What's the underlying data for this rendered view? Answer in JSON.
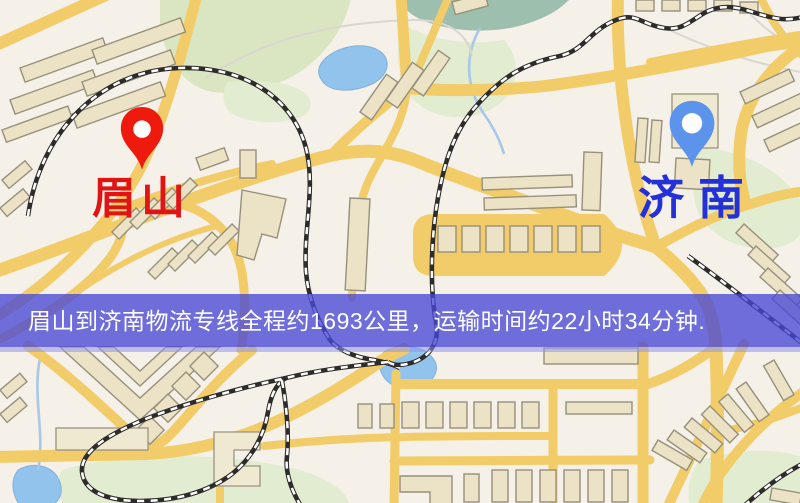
{
  "banner": {
    "text": "眉山到济南物流专线全程约1693公里，运输时间约22小时34分钟.",
    "background_color": "#4848d6",
    "text_color": "#ffffff"
  },
  "route": {
    "origin": "眉山",
    "destination": "济南",
    "distance_text": "约1693公里",
    "duration_text": "约22小时34分钟"
  },
  "map": {
    "markers": [
      {
        "name": "origin",
        "label": "眉山",
        "pin_color": "#ee1a0e",
        "label_color": "#e01414"
      },
      {
        "name": "destination",
        "label": "济南",
        "pin_color": "#5c94ec",
        "label_color": "#2531d8"
      }
    ],
    "palette": {
      "background": "#f5f0e8",
      "road": "#f1cc68",
      "building": "#ece3c6",
      "park": "#d9e6c1",
      "water": "#92c3ec",
      "railway": "#2e2c2a"
    }
  }
}
